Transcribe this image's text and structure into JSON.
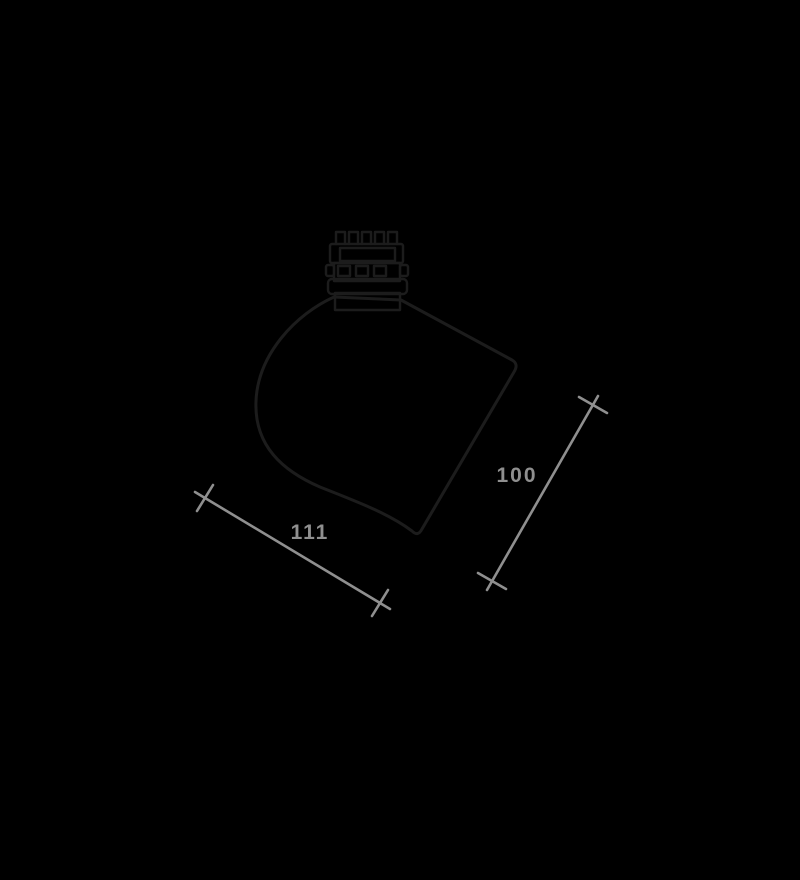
{
  "page": {
    "background_color": "#000000"
  },
  "drawing": {
    "line_color": "#1c1c1c",
    "dimension_color": "#8f8f8f",
    "dimensions": {
      "diagonal_height_label": "100",
      "diagonal_width_label": "111"
    }
  }
}
